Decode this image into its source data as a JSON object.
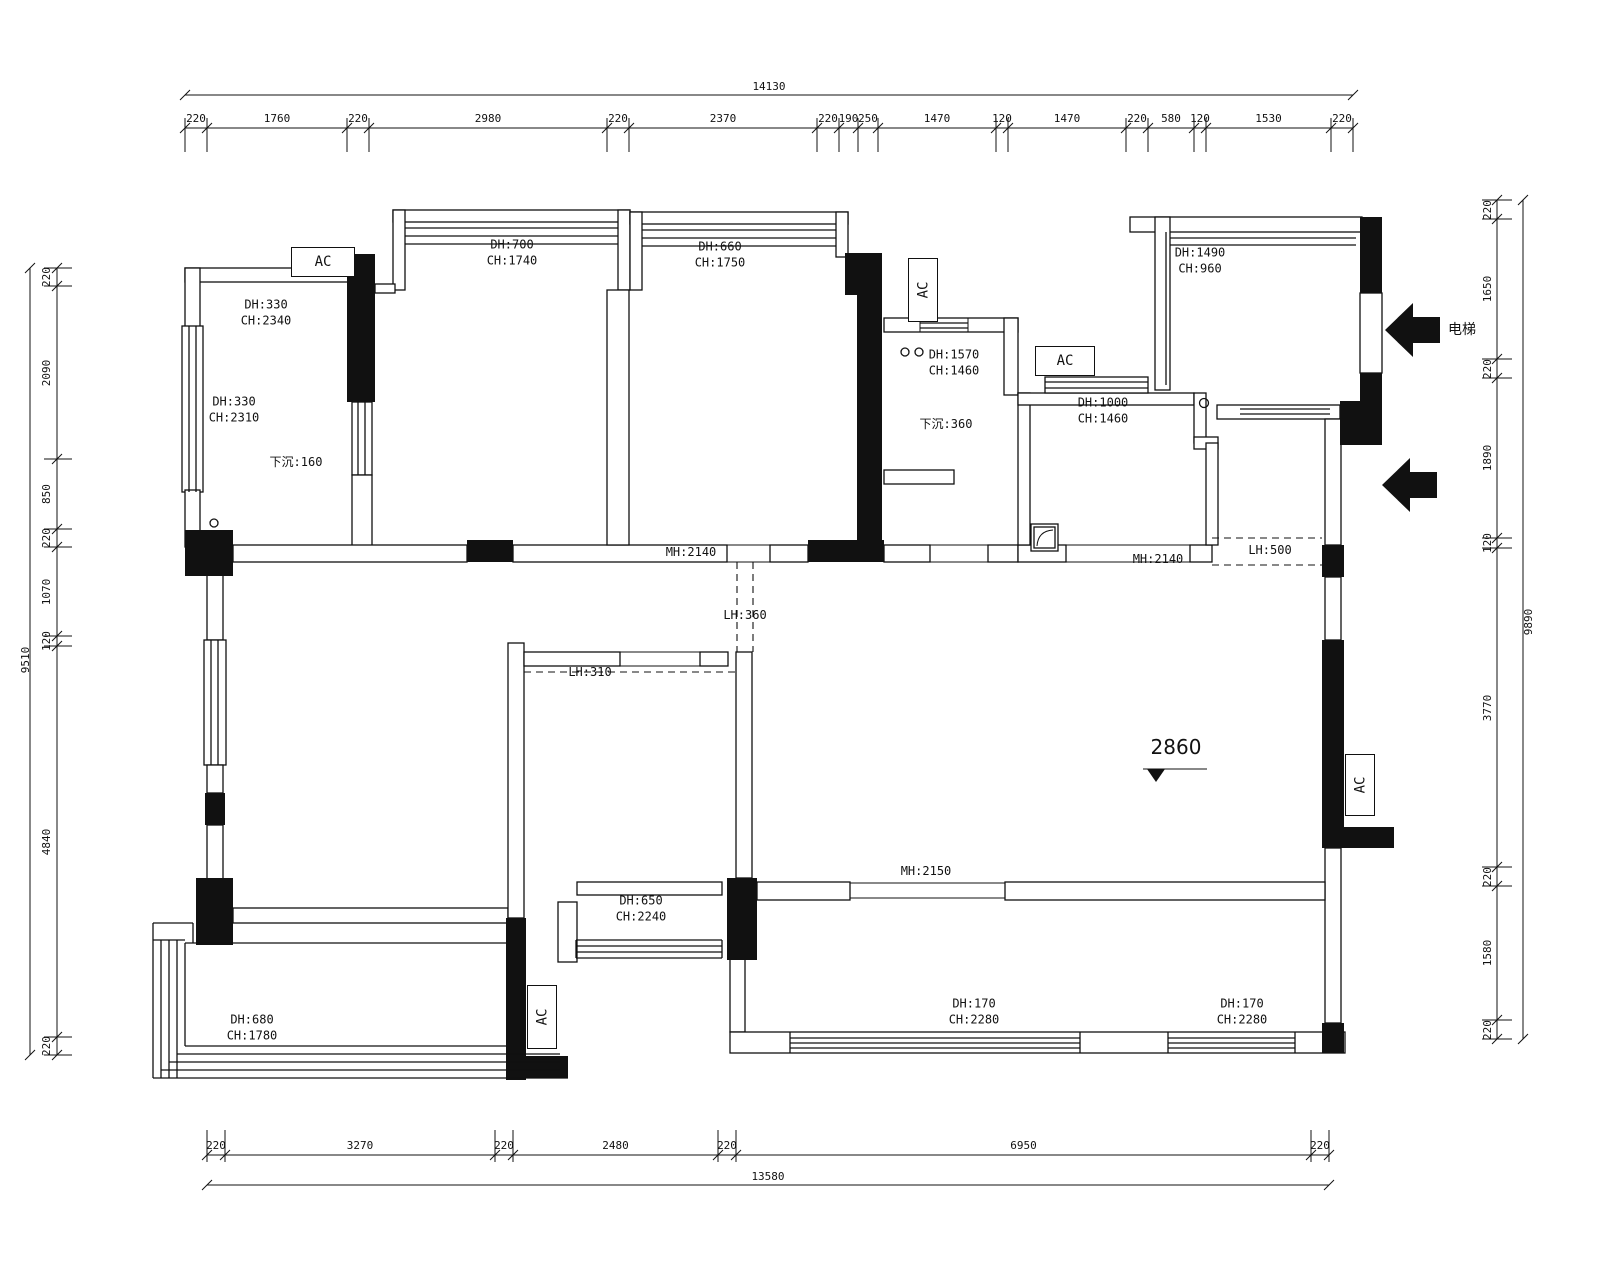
{
  "drawing": {
    "type": "residential floor plan",
    "level_mark": "2860",
    "elevator_label": "电梯",
    "ac_label": "AC"
  },
  "dimensions": {
    "top": {
      "total": "14130",
      "segments": [
        "220",
        "1760",
        "220",
        "2980",
        "220",
        "2370",
        "220",
        "190",
        "250",
        "1470",
        "120",
        "1470",
        "220",
        "580",
        "120",
        "1530",
        "220"
      ]
    },
    "bottom": {
      "total": "13580",
      "segments": [
        "220",
        "3270",
        "220",
        "2480",
        "220",
        "6950",
        "220"
      ]
    },
    "left": {
      "total": "9510",
      "segments": [
        "220",
        "2090",
        "850",
        "220",
        "1070",
        "120",
        "4840",
        "220"
      ]
    },
    "right": {
      "total": "9890",
      "segments": [
        "220",
        "1650",
        "220",
        "1890",
        "120",
        "3770",
        "220",
        "1580",
        "220"
      ]
    }
  },
  "labels": {
    "tl_window_a": "DH:330\nCH:2340",
    "tl_window_b": "DH:330\nCH:2310",
    "tl_sunken": "下沉:160",
    "top_bay_1": "DH:700\nCH:1740",
    "top_bay_2": "DH:660\nCH:1750",
    "kitchen_window": "DH:1570\nCH:1460",
    "kitchen_sunken": "下沉:360",
    "bath_window": "DH:1000\nCH:1460",
    "tr_window": "DH:1490\nCH:960",
    "door_hall": "MH:2140",
    "door_bath": "MH:2140",
    "lintel_hall": "LH:500",
    "lintel_mid": "LH:360",
    "lintel_study": "LH:310",
    "door_living": "MH:2150",
    "study_window": "DH:650\nCH:2240",
    "bl_balcony_window": "DH:680\nCH:1780",
    "br_window_1": "DH:170\nCH:2280",
    "br_window_2": "DH:170\nCH:2280"
  }
}
